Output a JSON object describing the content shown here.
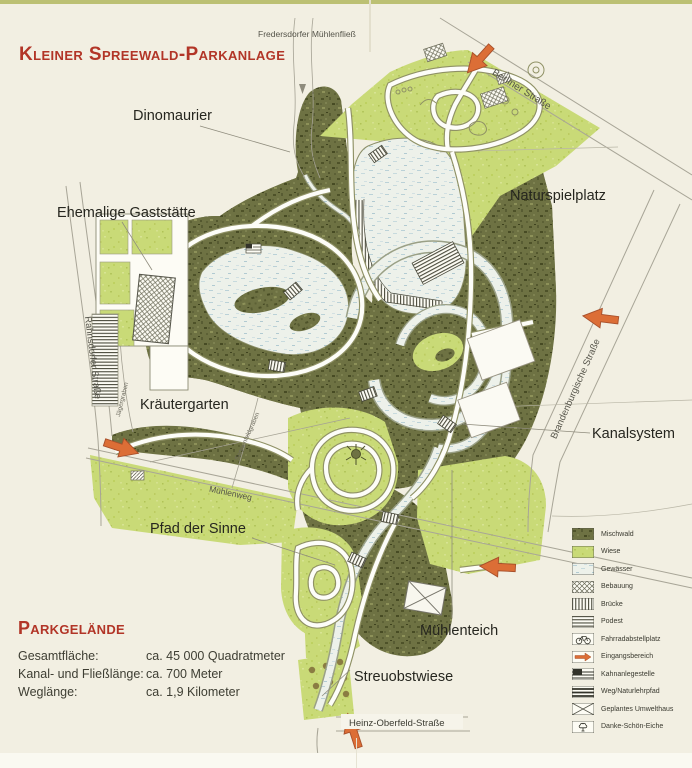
{
  "title": "Kleiner Spreewald-Parkanlage",
  "map": {
    "features": [
      {
        "text": "Dinomaurier"
      },
      {
        "text": "Ehemalige Gaststätte"
      },
      {
        "text": "Naturspielplatz"
      },
      {
        "text": "Kräutergarten"
      },
      {
        "text": "Kanalsystem"
      },
      {
        "text": "Pfad der Sinne"
      },
      {
        "text": "Mühlenteich"
      },
      {
        "text": "Streuobstwiese"
      }
    ],
    "streets": [
      {
        "name": "Fredersdorfer Mühlenfließ"
      },
      {
        "name": "Berliner Straße"
      },
      {
        "name": "Rahnsdorfer Straße"
      },
      {
        "name": "Brandenburgische Straße"
      },
      {
        "name": "Mühlenweg"
      },
      {
        "name": "Jägergraben"
      },
      {
        "name": "Sonnenfeldgraben"
      },
      {
        "name": "Heinz-Oberfeld-Straße"
      }
    ]
  },
  "info": {
    "heading": "Parkgelände",
    "rows": [
      {
        "label": "Gesamtfläche:",
        "value": "ca. 45 000 Quadratmeter"
      },
      {
        "label": "Kanal- und Fließlänge:",
        "value": "ca. 700 Meter"
      },
      {
        "label": "Weglänge:",
        "value": "ca. 1,9 Kilometer"
      }
    ]
  },
  "legend": {
    "items": [
      {
        "label": "Mischwald"
      },
      {
        "label": "Wiese"
      },
      {
        "label": "Gewässer"
      },
      {
        "label": "Bebauung"
      },
      {
        "label": "Brücke"
      },
      {
        "label": "Podest"
      },
      {
        "label": "Fahrradabstellplatz"
      },
      {
        "label": "Eingangsbereich"
      },
      {
        "label": "Kahnanlegestelle"
      },
      {
        "label": "Weg/Naturlehrpfad"
      },
      {
        "label": "Geplantes Umwelthaus"
      },
      {
        "label": "Danke-Schön-Eiche"
      }
    ]
  },
  "colors": {
    "accent_red": "#b23527",
    "mischwald": "#6e7243",
    "wiese": "#c9da77",
    "gewaesser": "#edf1ea",
    "entrance_orange": "#dc6e36"
  }
}
